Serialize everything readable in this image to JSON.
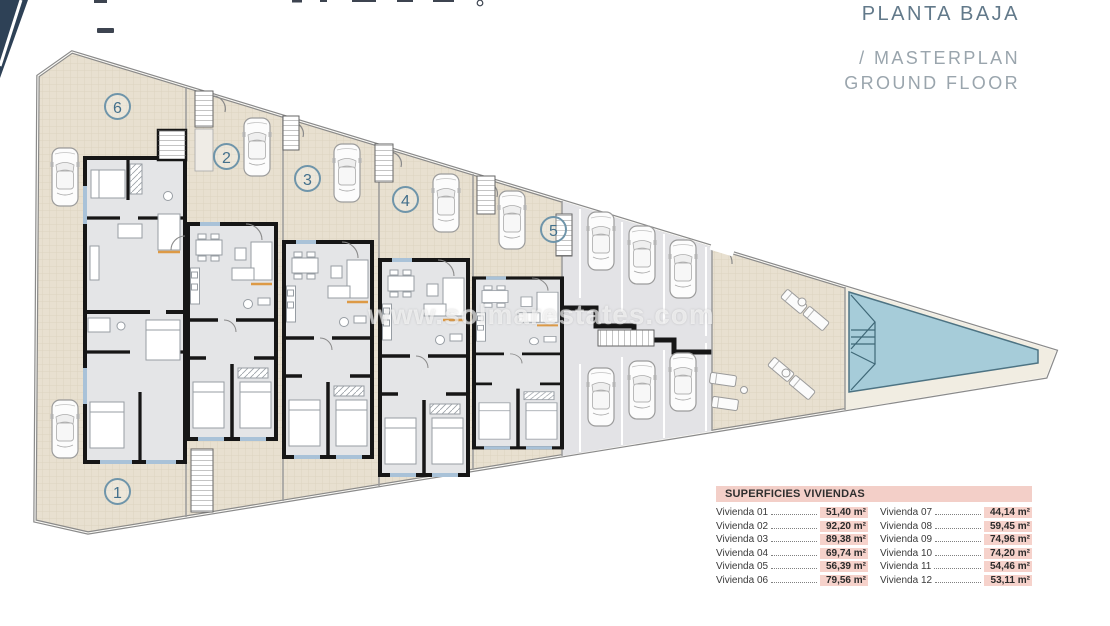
{
  "header": {
    "title": "PLANTA BAJA",
    "subtitle_line1": "/ MASTERPLAN",
    "subtitle_line2": "GROUND FLOOR"
  },
  "watermark": {
    "text": "www.solmarestates.com"
  },
  "plan": {
    "unit_badges": [
      {
        "label": "1"
      },
      {
        "label": "2"
      },
      {
        "label": "3"
      },
      {
        "label": "4"
      },
      {
        "label": "5"
      },
      {
        "label": "6"
      }
    ],
    "features": {
      "car_count": 12,
      "parking_bays": 6,
      "has_pool": true,
      "sun_loungers": 6,
      "outdoor_stairs": 6
    }
  },
  "areas_table": {
    "title": "SUPERFICIES VIVIENDAS",
    "col1": [
      {
        "label": "Vivienda 01",
        "value": "51,40 m²"
      },
      {
        "label": "Vivienda 02",
        "value": "92,20 m²"
      },
      {
        "label": "Vivienda 03",
        "value": "89,38 m²"
      },
      {
        "label": "Vivienda 04",
        "value": "69,74 m²"
      },
      {
        "label": "Vivienda 05",
        "value": "56,39 m²"
      },
      {
        "label": "Vivienda 06",
        "value": "79,56 m²"
      }
    ],
    "col2": [
      {
        "label": "Vivienda 07",
        "value": "44,14 m²"
      },
      {
        "label": "Vivienda 08",
        "value": "59,45 m²"
      },
      {
        "label": "Vivienda 09",
        "value": "74,96 m²"
      },
      {
        "label": "Vivienda 10",
        "value": "74,20 m²"
      },
      {
        "label": "Vivienda 11",
        "value": "54,46 m²"
      },
      {
        "label": "Vivienda 12",
        "value": "53,11 m²"
      }
    ]
  },
  "colors": {
    "corner_navy": "#2e4156",
    "title_blue": "#62798a",
    "subtitle_gray": "#9aa5ad",
    "site_beige": "#e8e0d0",
    "parking_gray": "#e3e3e6",
    "pool_blue": "#a6ccd9",
    "interior_gray": "#e4e5e7",
    "wall_black": "#161616",
    "table_header_pink": "#f3cfc8",
    "value_highlight_pink": "#f6d2cb",
    "badge_blue": "#6f95aa"
  }
}
